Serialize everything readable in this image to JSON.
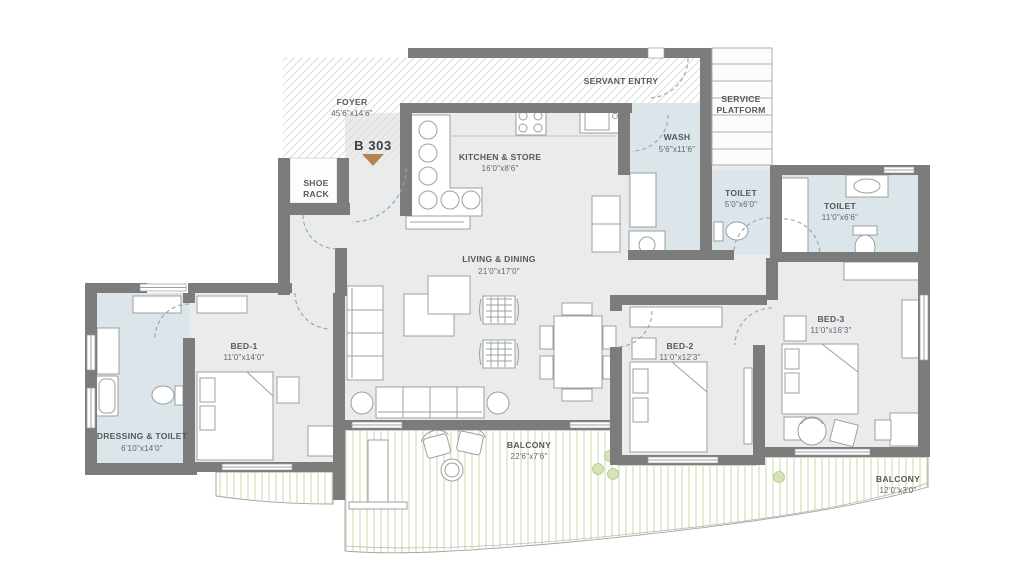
{
  "unit": {
    "label": "B 303"
  },
  "rooms": {
    "foyer": {
      "name": "FOYER",
      "dims": "45'6\"x14'6\""
    },
    "servant_entry": {
      "name": "SERVANT ENTRY"
    },
    "service_platform": {
      "line1": "SERVICE",
      "line2": "PLATFORM"
    },
    "shoe_rack": {
      "line1": "SHOE",
      "line2": "RACK"
    },
    "kitchen": {
      "name": "KITCHEN & STORE",
      "dims": "16'0\"x8'6\""
    },
    "wash": {
      "name": "WASH",
      "dims": "5'6\"x11'6\""
    },
    "toilet_small": {
      "name": "TOILET",
      "dims": "5'0\"x6'0\""
    },
    "toilet_master": {
      "name": "TOILET",
      "dims": "11'0\"x6'6\""
    },
    "living_dining": {
      "name": "LIVING & DINING",
      "dims": "21'0\"x17'0\""
    },
    "bed_1": {
      "name": "BED-1",
      "dims": "11'0\"x14'0\""
    },
    "dressing_toilet": {
      "name": "DRESSING & TOILET",
      "dims": "6'10\"x14'0\""
    },
    "bed_2": {
      "name": "BED-2",
      "dims": "11'0\"x12'3\""
    },
    "bed_3": {
      "name": "BED-3",
      "dims": "11'0\"x16'3\""
    },
    "balcony_main": {
      "name": "BALCONY",
      "dims": "22'6\"x7'6\""
    },
    "balcony_side": {
      "name": "BALCONY",
      "dims": "12'0\"x3'0\""
    }
  },
  "colors": {
    "wall": "#7c7c7c",
    "floor": "#e9ebed",
    "wet_floor": "#dbe5ea",
    "balcony_stripe": "#ccdeb1",
    "entry_marker": "#b5854f",
    "label_text": "#57595b"
  }
}
